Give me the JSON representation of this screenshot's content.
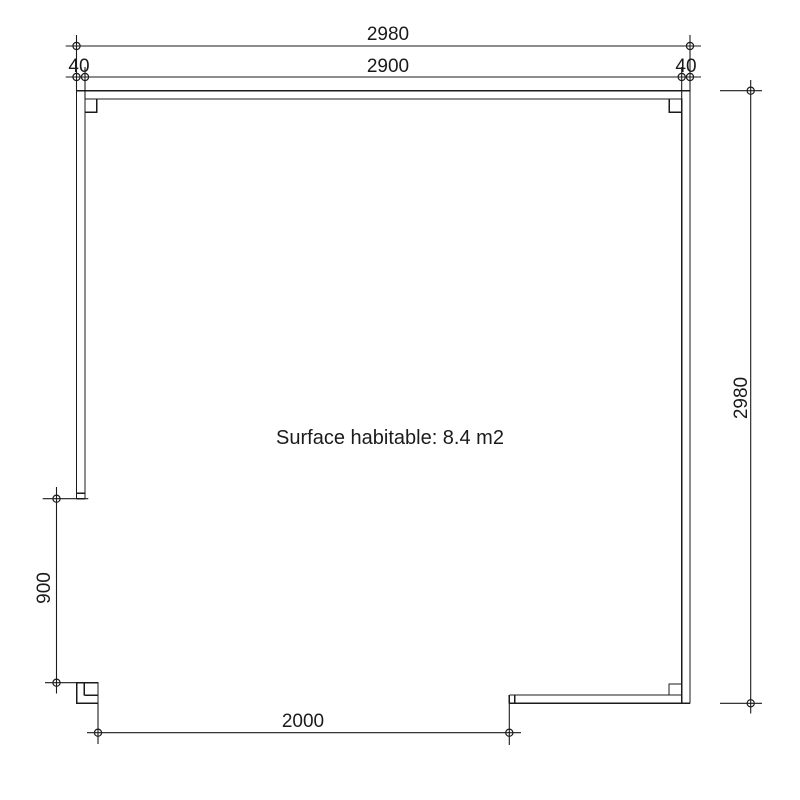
{
  "colors": {
    "line": "#1b1b1b",
    "background": "#ffffff"
  },
  "plan": {
    "area_label": "Surface habitable: 8.4 m2",
    "dimensions": {
      "overall_width": "2980",
      "inner_width": "2900",
      "wall_thickness_left": "40",
      "wall_thickness_right": "40",
      "overall_height": "2980",
      "left_opening_height": "900",
      "door_opening_width": "2000"
    }
  }
}
